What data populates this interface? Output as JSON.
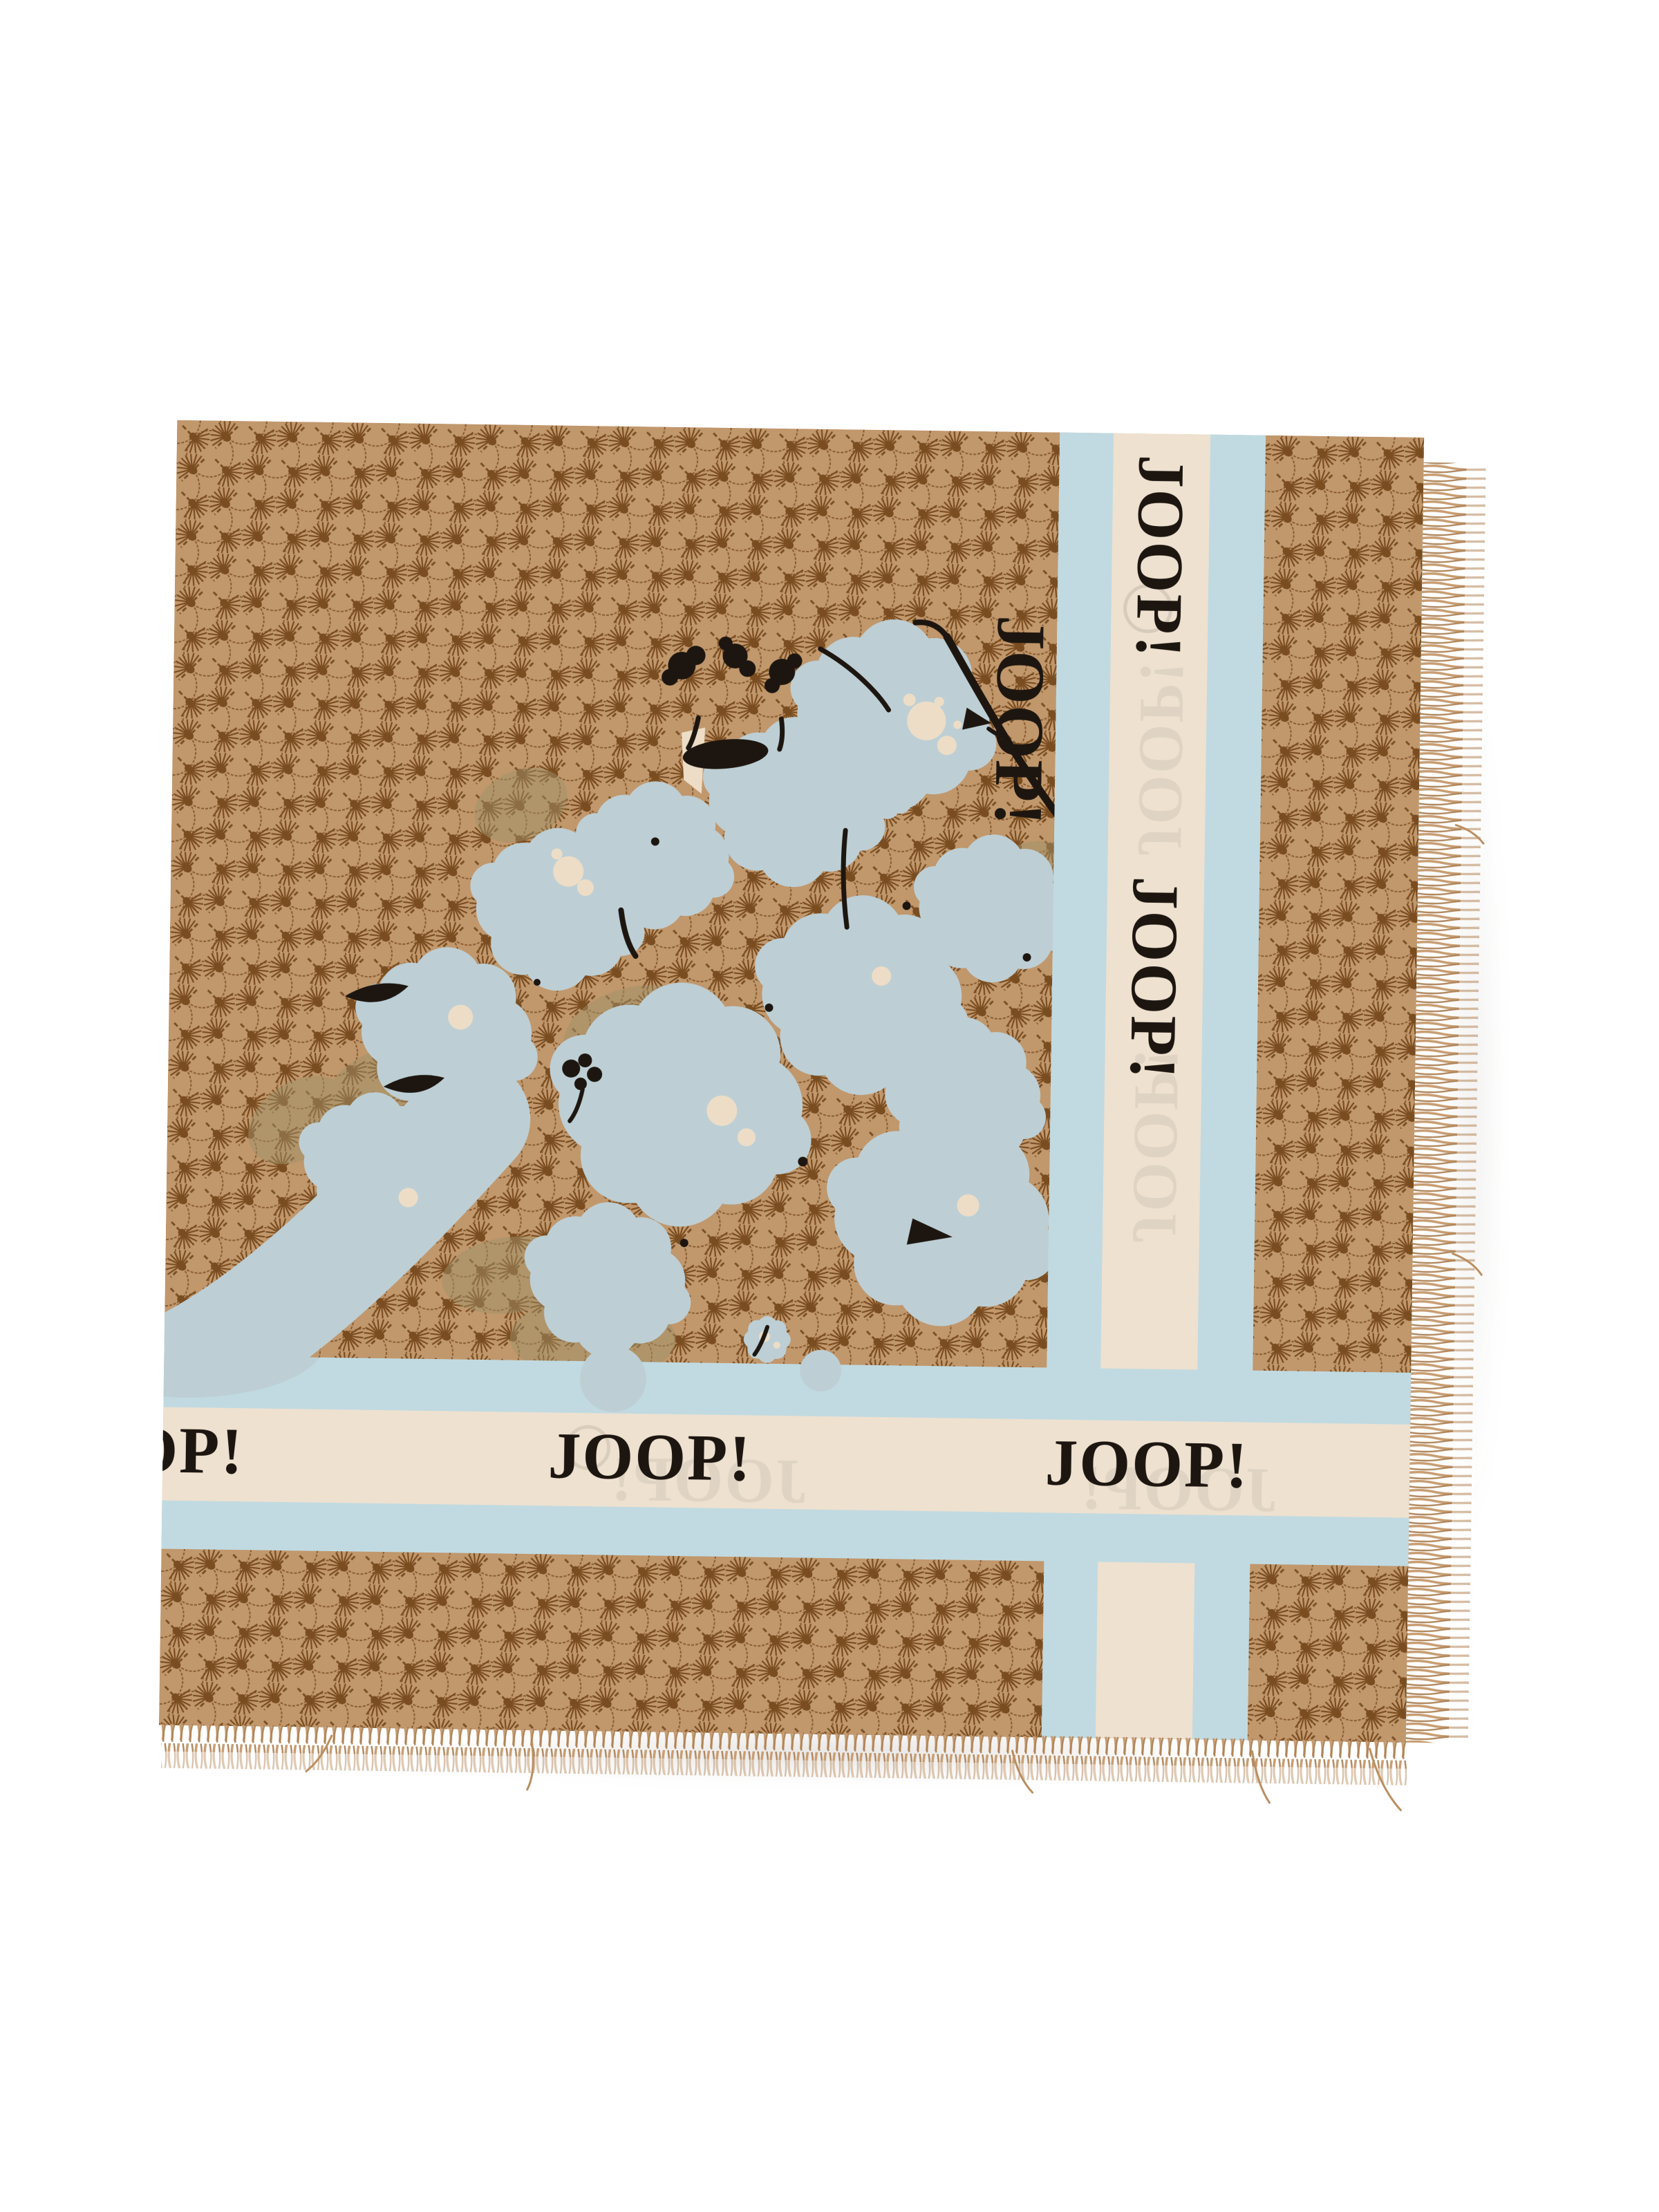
{
  "page": {
    "background": "#ffffff",
    "type": "product photo on white"
  },
  "product": {
    "brand": "JOOP!",
    "item": "Square logo scarf with cornflower monogram and floral print",
    "pattern_name": "cornflower monogram",
    "edges": "fringed right and bottom edges"
  },
  "colors": {
    "camel": "#c59b6e",
    "monogram_brown": "#7c4e20",
    "stripe_blue": "#c6e0e8",
    "flower_blue": "#c2d5db",
    "cream_band": "#f4e8d6",
    "cream_accent": "#f3e4cd",
    "logo_black": "#1c1610",
    "khaki_shadow": "#a3946a",
    "fringe_tan": "#c79d72",
    "ghost_gray": "#8a8178"
  },
  "scarf": {
    "horizontal_band": {
      "labels": [
        "JOOP!",
        "JOOP!",
        "JOOP!"
      ]
    },
    "vertical_band": {
      "labels": [
        "JOOP!",
        "JOOP!"
      ]
    },
    "signature": "JOOP!",
    "ghosts": {
      "h1": "JOOP!",
      "h2": "JOOP!",
      "v1": "JOOP!",
      "v2": "JOOP!"
    }
  }
}
